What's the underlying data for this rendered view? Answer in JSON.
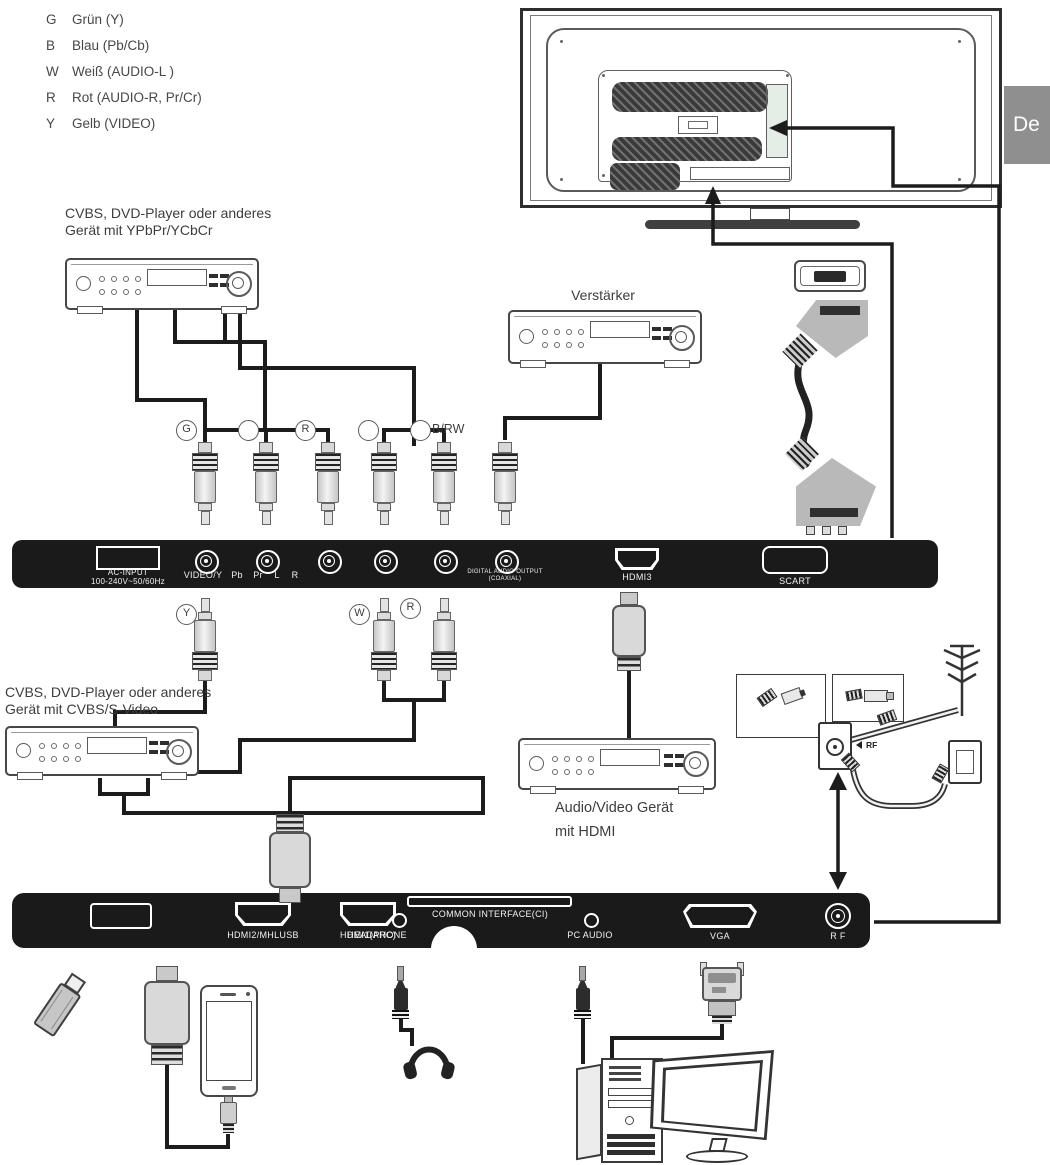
{
  "language_tab": {
    "label": "De"
  },
  "legend": {
    "items": [
      {
        "key": "G",
        "desc": "Grün (Y)"
      },
      {
        "key": "B",
        "desc": "Blau (Pb/Cb)"
      },
      {
        "key": "W",
        "desc": "Weiß (AUDIO-L )"
      },
      {
        "key": "R",
        "desc": "Rot (AUDIO-R, Pr/Cr)"
      },
      {
        "key": "Y",
        "desc": "Gelb (VIDEO)"
      }
    ]
  },
  "devices": {
    "dvd_component": {
      "line1": "CVBS, DVD-Player oder anderes",
      "line2": "Gerät mit YPbPr/YCbCr"
    },
    "amplifier": {
      "label": "Verstärker"
    },
    "dvd_cvbs": {
      "line1": "CVBS, DVD-Player oder anderes",
      "line2": "Gerät mit CVBS/S-Video"
    },
    "av_hdmi": {
      "line1": "Audio/Video Gerät",
      "line2": "mit HDMI"
    }
  },
  "plug_labels": {
    "row1": [
      {
        "letter": "G"
      },
      {
        "letter": ""
      },
      {
        "letter": "R"
      },
      {
        "letter": ""
      },
      {
        "letter": "",
        "suffix": "B/RW"
      }
    ],
    "row2": [
      {
        "letter": "Y"
      },
      {
        "letter": "W"
      },
      {
        "letter": "R"
      }
    ]
  },
  "rear_panel_top": {
    "ac_line1": "AC-INPUT",
    "ac_line2": "100-240V~50/60Hz",
    "jack_videoy": "VIDEO/Y",
    "jack_pb": "Pb",
    "jack_pr": "Pr",
    "jack_l": "L",
    "jack_r": "R",
    "digital_line1": "DIGITAL AUDIO OUTPUT",
    "digital_line2": "(COAXIAL)",
    "hdmi3": "HDMI3",
    "scart": "SCART"
  },
  "rear_panel_bottom": {
    "hdmi2": "HDMI2/MHLUSB",
    "hdmi1": "HDMI1(ARC)",
    "headphone": "HEADPHONE",
    "ci": "COMMON INTERFACE(CI)",
    "pc_audio": "PC AUDIO",
    "vga": "VGA",
    "rf": "R F"
  },
  "rf_section": {
    "callout": "RF"
  },
  "colors": {
    "panel": "#1a1a1a",
    "tab_bg": "#8f8f8f",
    "line": "#1c1c1c"
  }
}
